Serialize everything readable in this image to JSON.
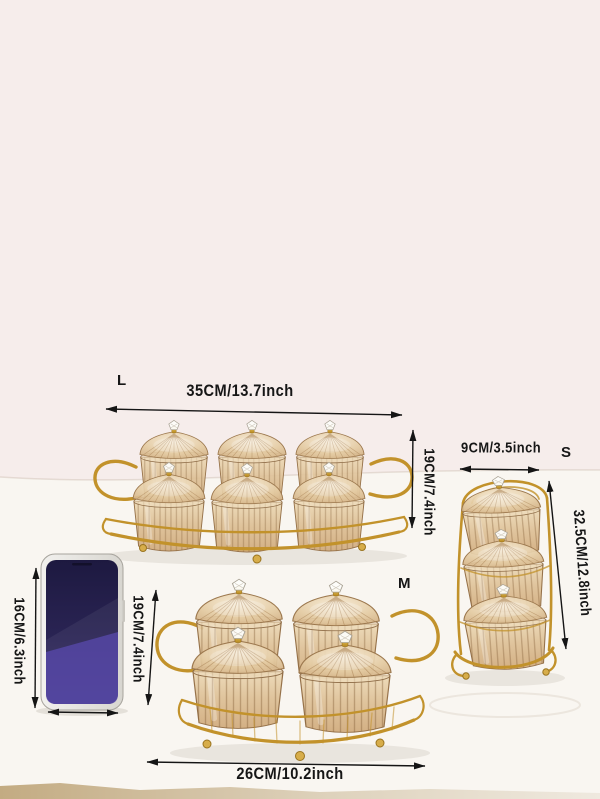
{
  "items": {
    "tray_l": {
      "size_label": "L",
      "width_label": "35CM/13.7inch",
      "height_label": "19CM/7.4inch"
    },
    "stand_s": {
      "size_label": "S",
      "width_label": "9CM/3.5inch",
      "height_label": "32.5CM/12.8inch"
    },
    "tray_m": {
      "size_label": "M",
      "width_label": "26CM/10.2inch",
      "height_label": "19CM/7.4inch"
    },
    "phone": {
      "height_label": "16CM/6.3inch"
    }
  },
  "colors": {
    "annotation": "#151515",
    "gold_wire": "#c2922b",
    "glass": "#ddbf94",
    "wall_background": "#f6edeb",
    "table_surface": "#f9f6f1",
    "phone_screen": "#2a2454",
    "table_edge_band": "#c3ab82"
  }
}
